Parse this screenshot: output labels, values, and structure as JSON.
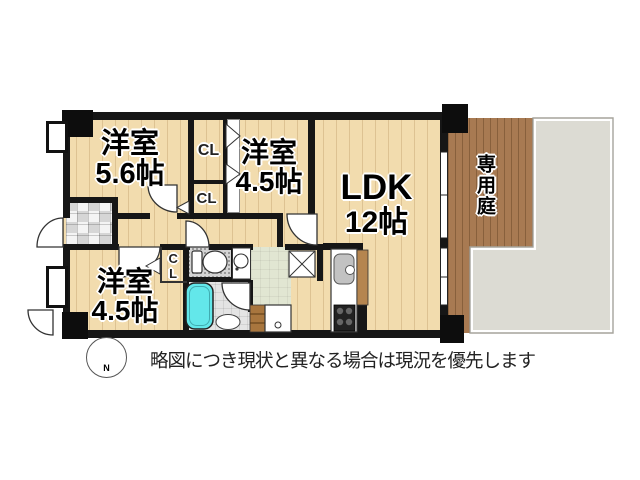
{
  "plan": {
    "rooms": {
      "room_top_left": {
        "name": "洋室",
        "size": "5.6帖"
      },
      "room_top_mid": {
        "name": "洋室",
        "size": "4.5帖"
      },
      "ldk": {
        "name": "LDK",
        "size": "12帖"
      },
      "room_bottom_left": {
        "name": "洋室",
        "size": "4.5帖"
      },
      "garden": {
        "name": "専用庭"
      }
    },
    "closets": {
      "cl_upper": "CL",
      "cl_lower": "CL",
      "cl_bedroom": "CL"
    }
  },
  "compass": {
    "north_label": "N"
  },
  "footer": {
    "disclaimer": "略図につき現状と異なる場合は現況を優先します"
  },
  "colors": {
    "wall": "#161616",
    "wood_floor": "#f2dcae",
    "garden_deck": "#a87a52",
    "concrete": "#dcdbd3",
    "bathtub": "#63e7ea",
    "powder_room": "#e1e6d2"
  }
}
